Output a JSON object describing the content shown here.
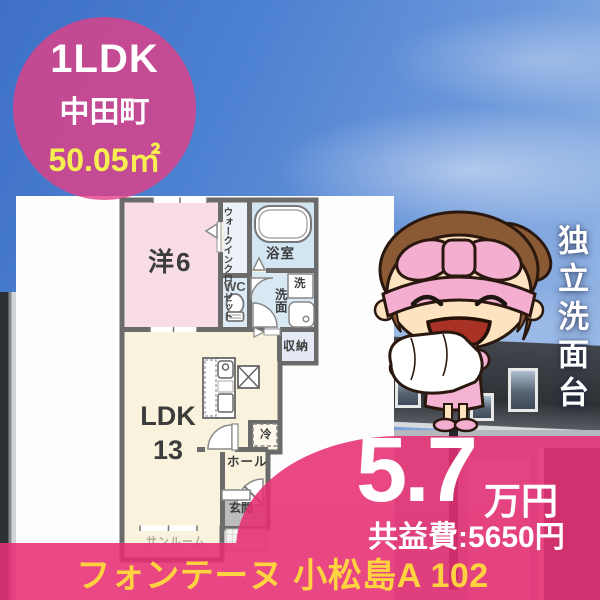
{
  "badge": {
    "layout": "1LDK",
    "location": "中田町",
    "area": "50.05㎡"
  },
  "feature_vertical": "独立洗面台",
  "price": {
    "amount": "5.7",
    "unit": "万円",
    "common_fee": "共益費:5650円"
  },
  "property_name": "フォンテーヌ 小松島A 102",
  "floorplan": {
    "western_room": "洋6",
    "walk_in_closet": "ウォークインクローゼット",
    "bathroom": "浴室",
    "toilet": "WC",
    "washroom": "洗面",
    "washer": "洗",
    "storage": "収納",
    "ldk_label": "LDK",
    "ldk_size": "13",
    "fridge": "冷",
    "hall": "ホール",
    "entrance": "玄関",
    "sunroom": "サンルーム"
  },
  "colors": {
    "accent_pink": "#e62f74",
    "badge_pink": "#e23e82",
    "area_yellow": "#f7ee52",
    "title_gold": "#ffd23f",
    "wall_gray": "#6b6b6b",
    "room_pink": "#f8dce8",
    "room_blue": "#d2e5f2",
    "room_cream": "#f9f2dd"
  }
}
